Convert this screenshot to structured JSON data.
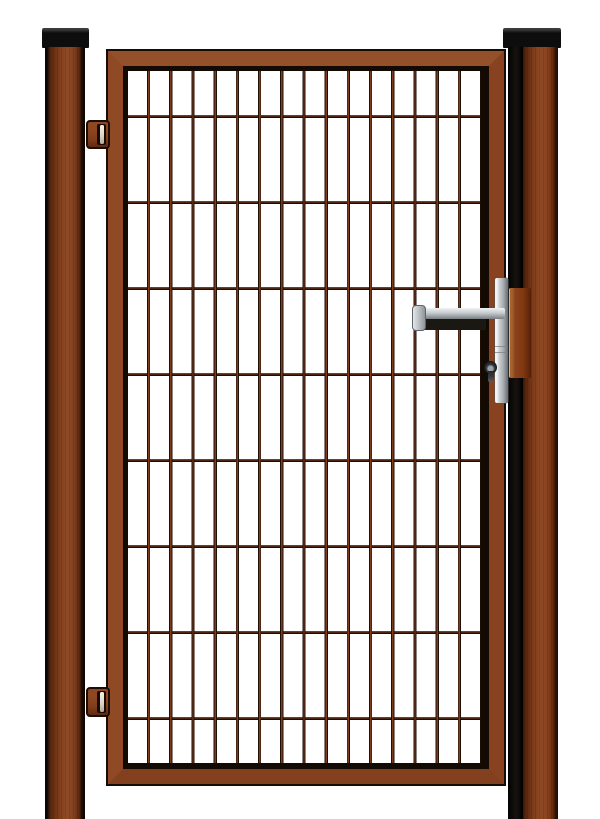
{
  "image": {
    "type": "product-photo",
    "subject": "Single-leaf garden gate with wire mesh panel",
    "description": "Brown powder-coated single garden gate: rectangular gate frame with welded double-wire mesh infill (16 vertical bars, 8 horizontal wires), hung between two square brown posts with flat black caps; two adjustable brown hinges on the left side; silver lever handle with lock escutcheon and euro-profile keyhole on the right side; brown strike plate mounted on the right post; plain white background",
    "background_color": "#ffffff"
  },
  "colors": {
    "background": "#ffffff",
    "cap_black": "#0d0d0d",
    "frame_brown": "#8a4421",
    "frame_outline": "#170b05",
    "post_brown": "#7d3b1b",
    "mesh_bar_brown": "#7c3d1e",
    "mesh_wire_dark": "#1d0d05",
    "hinge_brown": "#7e3c1b",
    "hardware_silver": "#aab0b4",
    "handle_underside": "#1a1812",
    "keyhole_gray": "#232628",
    "strike_plate_brown": "#8a421c"
  },
  "mesh": {
    "vertical_bars": 16,
    "horizontal_wires": 8
  },
  "objects": {
    "left_post": "left square post with black cap",
    "right_post": "right square post with black cap",
    "gate_leaf": "gate leaf frame with welded mesh infill",
    "hinges": [
      "top hinge",
      "bottom hinge"
    ],
    "handle": "silver lever handle",
    "escutcheon": "lock escutcheon plate with euro keyhole",
    "strike_plate": "strike plate on right post"
  }
}
